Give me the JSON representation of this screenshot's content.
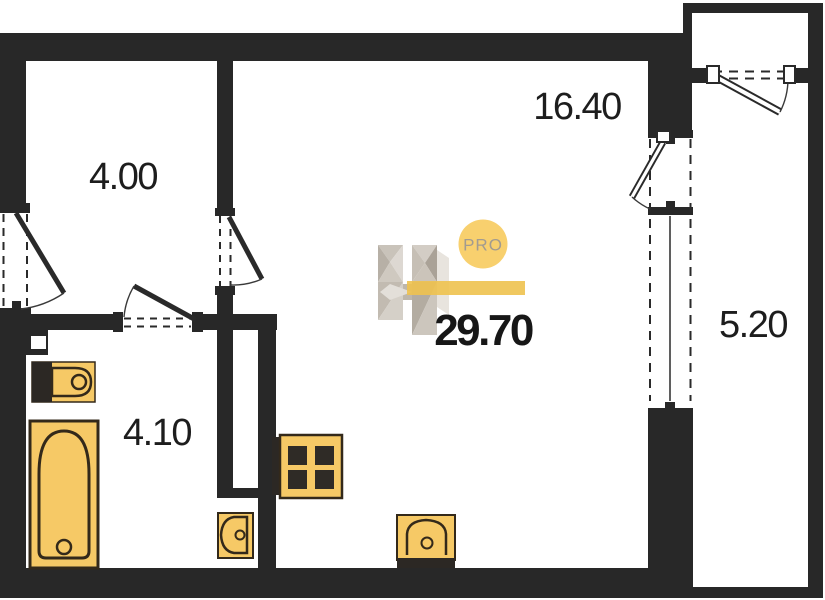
{
  "plan": {
    "type": "apartment-floorplan",
    "total_area": "29.70",
    "rooms": [
      {
        "id": "hall",
        "area": "4.00"
      },
      {
        "id": "living",
        "area": "16.40"
      },
      {
        "id": "bathroom",
        "area": "4.10"
      },
      {
        "id": "balcony",
        "area": "5.20"
      }
    ],
    "logo": {
      "badge": "PRO"
    },
    "colors": {
      "wall": "#282828",
      "fixture_fill": "#f6c966",
      "fixture_outline": "#33291a",
      "accent_bar": "#eec24f",
      "badge_circle": "#f8d06e",
      "label_text": "#1d1d1d"
    }
  }
}
